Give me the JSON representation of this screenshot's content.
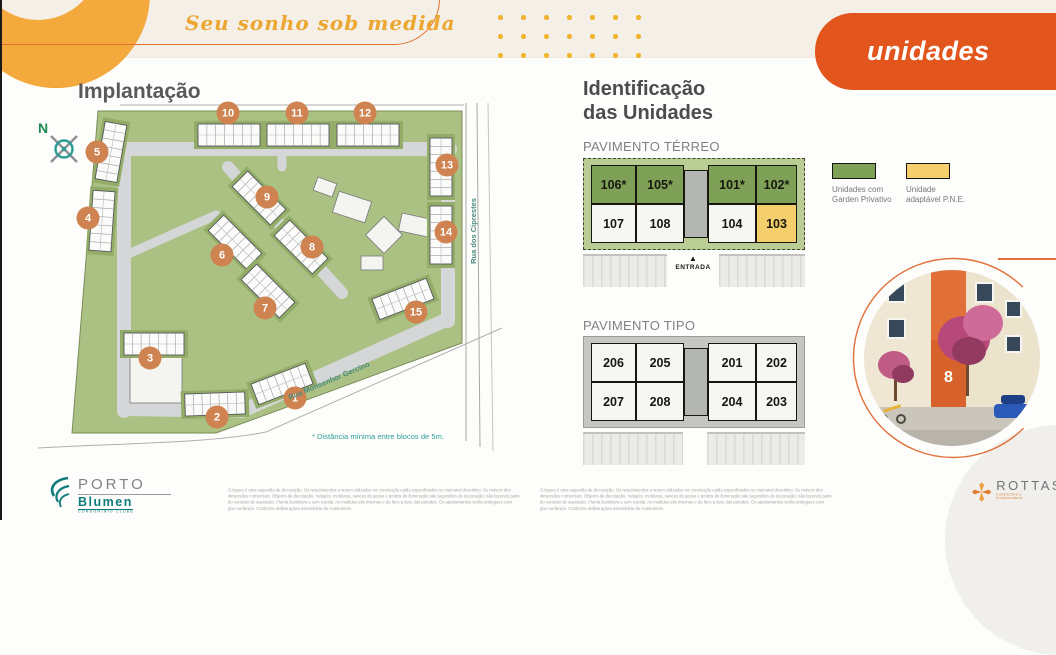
{
  "colors": {
    "accent_orange": "#e2551c",
    "amber": "#f3a93c",
    "marker_orange": "#cf8350",
    "garden_green": "#7ea157",
    "pne_yellow": "#f5cf6b",
    "teal": "#2d9a93"
  },
  "header": {
    "tagline": "Seu sonho sob medida",
    "banner": "unidades"
  },
  "site_plan": {
    "title": "Implantação",
    "compass": "N",
    "streets": {
      "right": "Rua dos Ciprestes",
      "bottom": "Rua Monsenhor Gercino"
    },
    "note": "* Distância mínima entre blocos de 5m.",
    "markers": [
      {
        "n": "1",
        "x": 275,
        "y": 303
      },
      {
        "n": "2",
        "x": 197,
        "y": 322
      },
      {
        "n": "3",
        "x": 130,
        "y": 263
      },
      {
        "n": "4",
        "x": 68,
        "y": 123
      },
      {
        "n": "5",
        "x": 77,
        "y": 57
      },
      {
        "n": "6",
        "x": 202,
        "y": 160
      },
      {
        "n": "7",
        "x": 245,
        "y": 213
      },
      {
        "n": "8",
        "x": 292,
        "y": 152
      },
      {
        "n": "9",
        "x": 247,
        "y": 102
      },
      {
        "n": "10",
        "x": 208,
        "y": 18
      },
      {
        "n": "11",
        "x": 277,
        "y": 18
      },
      {
        "n": "12",
        "x": 345,
        "y": 18
      },
      {
        "n": "13",
        "x": 427,
        "y": 70
      },
      {
        "n": "14",
        "x": 426,
        "y": 137
      },
      {
        "n": "15",
        "x": 396,
        "y": 217
      }
    ]
  },
  "identification": {
    "title": "Identificação\ndas Unidades"
  },
  "terreo": {
    "label": "PAVIMENTO TÉRREO",
    "entrada": "ENTRADA",
    "top_units": [
      {
        "label": "106*",
        "type": "garden"
      },
      {
        "label": "105*",
        "type": "garden"
      },
      {
        "label": "101*",
        "type": "garden"
      },
      {
        "label": "102*",
        "type": "garden"
      }
    ],
    "bottom_units": [
      {
        "label": "107",
        "type": "standard"
      },
      {
        "label": "108",
        "type": "standard"
      },
      {
        "label": "104",
        "type": "standard"
      },
      {
        "label": "103",
        "type": "pne"
      }
    ]
  },
  "tipo": {
    "label": "PAVIMENTO TIPO",
    "top_units": [
      {
        "label": "206",
        "type": "standard"
      },
      {
        "label": "205",
        "type": "standard"
      },
      {
        "label": "201",
        "type": "standard"
      },
      {
        "label": "202",
        "type": "standard"
      }
    ],
    "bottom_units": [
      {
        "label": "207",
        "type": "standard"
      },
      {
        "label": "208",
        "type": "standard"
      },
      {
        "label": "204",
        "type": "standard"
      },
      {
        "label": "203",
        "type": "standard"
      }
    ]
  },
  "legend": {
    "garden": {
      "label": "Unidades com\nGarden Privativo",
      "color": "#7ea157"
    },
    "pne": {
      "label": "Unidade\nadaptável P.N.E.",
      "color": "#f5cf6b"
    }
  },
  "photo": {
    "block_number": "8"
  },
  "footer": {
    "disclaimer": "O layout é uma sugestão de decoração. Os revestimentos a serem utilizados na construção estão especificados no memorial descritivo. Os móveis têm dimensões comerciais. Objetos de decoração, rodapés, molduras, sancas de gesso e pontos de iluminação são sugestões de decoração, não fazendo parte do contrato de aquisição. Planta ilustrativa e sem escala. As medidas são internas e de face a face das paredes. Os apartamentos serão entregues com piso cerâmico. Conforme deliberações assembleia de condomínio.",
    "porto_logo": {
      "line1": "PORTO",
      "line2": "Blumen",
      "line3": "CONDOMÍNIO CLUBE"
    },
    "rottas_logo": {
      "name": "ROTTAS",
      "subtitle": "Construtora e Incorporadora"
    }
  }
}
